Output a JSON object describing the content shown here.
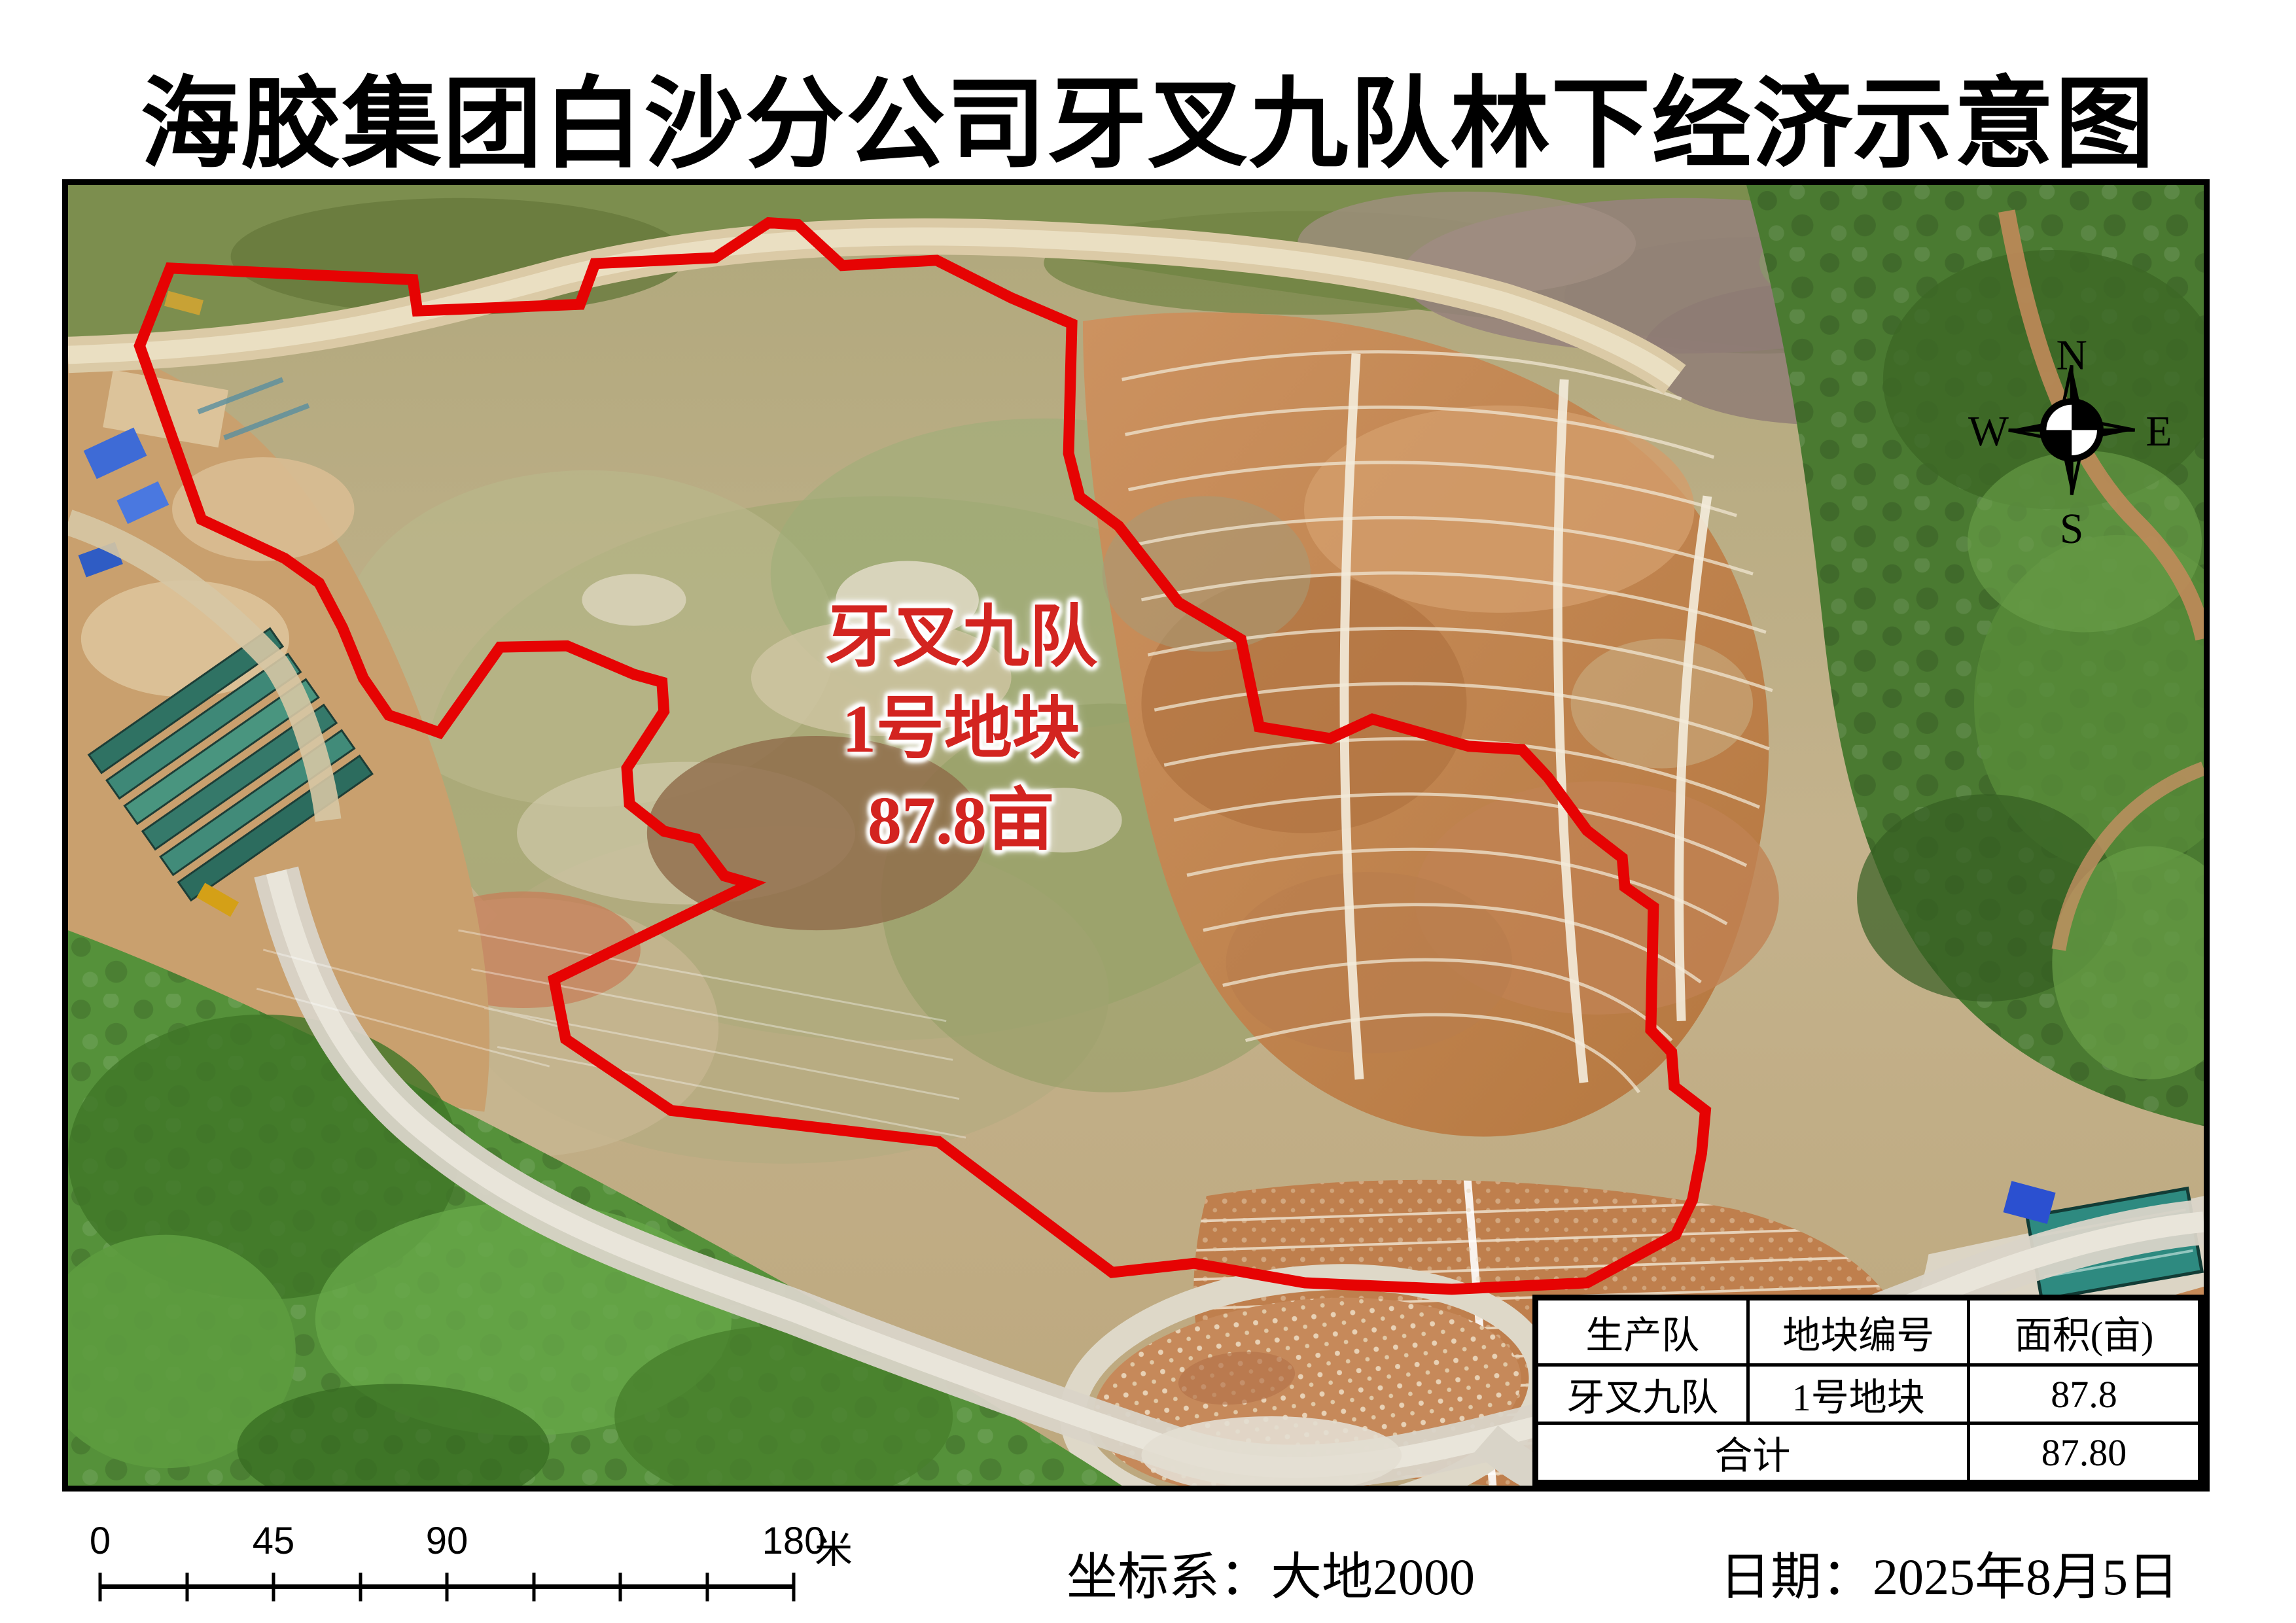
{
  "title": "海胶集团白沙分公司牙叉九队林下经济示意图",
  "map": {
    "plot_label": {
      "team": "牙叉九队",
      "plot": "1号地块",
      "area": "87.8亩"
    },
    "compass": {
      "n": "N",
      "e": "E",
      "s": "S",
      "w": "W"
    },
    "boundary_color": "#e60303",
    "boundary_points": "110,248 157,128 530,146 537,194 787,184 810,121 995,112 1077,58 1122,61 1190,124 1335,116 1450,174 1543,214 1538,414 1555,481 1615,526 1707,644 1803,701 1831,836 1940,854 2005,824 2153,866 2235,871 2275,914 2335,996 2389,1038 2393,1083 2437,1114 2433,1304 2465,1338 2469,1391 2517,1428 2511,1494 2497,1566 2471,1620 2335,1694 2127,1704 1901,1694 1731,1664 1605,1678 1338,1476 927,1428 765,1318 747,1226 1050,1078 1009,1066 966,1009 916,997 863,955 859,900 916,812 913,767 870,755 767,711 664,713 571,845 532,831 493,818 454,761 422,683 386,614 333,576 205,516"
  },
  "table": {
    "headers": [
      "生产队",
      "地块编号",
      "面积(亩)"
    ],
    "row": {
      "team": "牙叉九队",
      "plot": "1号地块",
      "area": "87.8"
    },
    "total_label": "合计",
    "total_area": "87.80"
  },
  "scale_bar": {
    "t0": "0",
    "t45": "45",
    "t90": "90",
    "t180": "180",
    "unit": "米"
  },
  "footer": {
    "crs": "坐标系：大地2000",
    "date": "日期：2025年8月5日"
  }
}
